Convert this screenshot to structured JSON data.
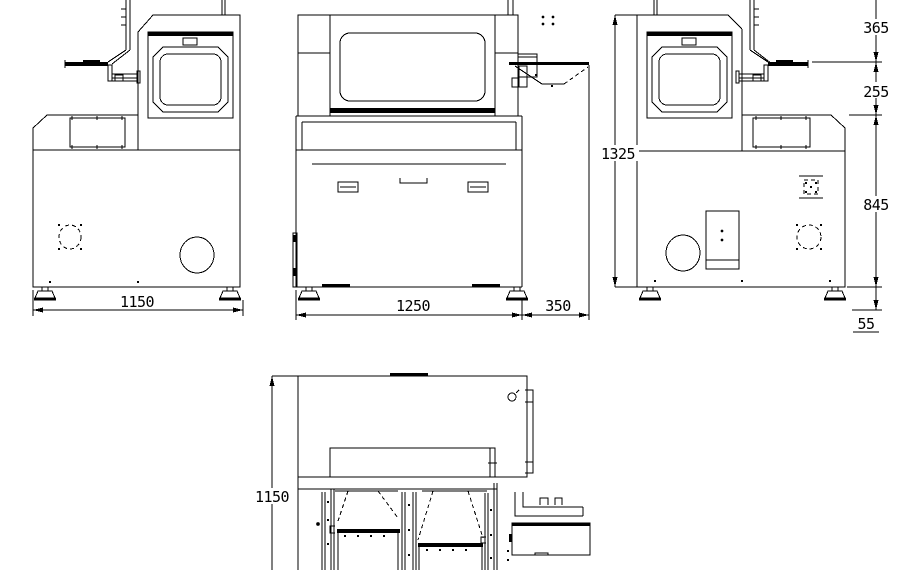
{
  "dims": {
    "left_view_width": "1150",
    "front_view_width": "1250",
    "front_view_outfeed": "350",
    "right_view_seg_top": "365",
    "right_view_seg_upper": "255",
    "right_view_total_height": "1325",
    "right_view_body": "845",
    "right_view_foot": "55",
    "plan_view_depth": "1150"
  },
  "colors": {
    "background": "#ffffff",
    "line": "#000000"
  }
}
